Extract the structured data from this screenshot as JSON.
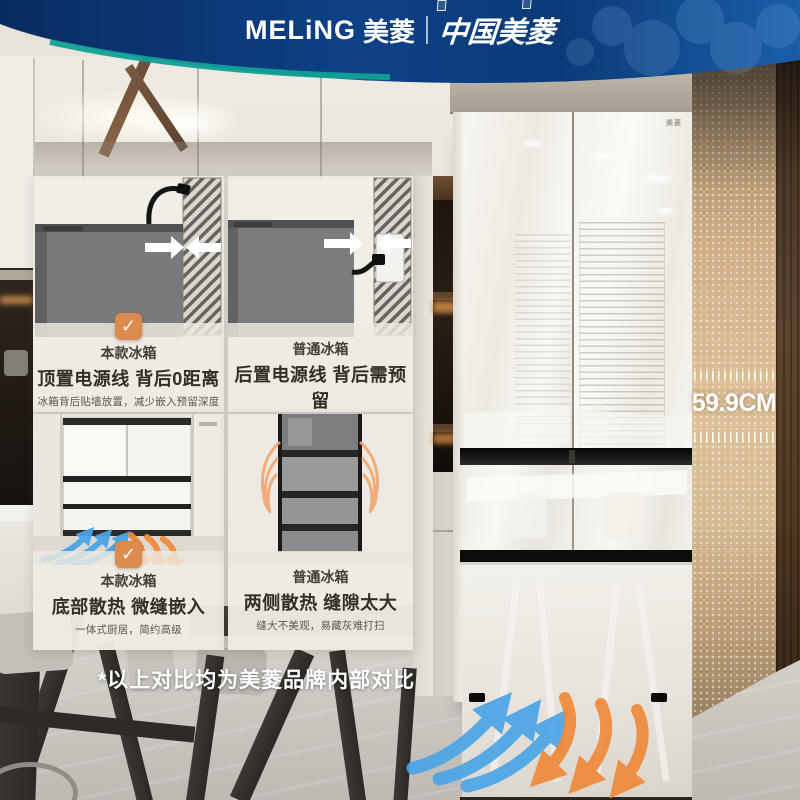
{
  "header": {
    "brand_en": "MELiNG",
    "brand_cn": "美菱",
    "divider": "|",
    "sub_brand": "中国美菱"
  },
  "panels": [
    {
      "badge": "✓",
      "label": "本款冰箱",
      "title": "顶置电源线 背后0距离",
      "desc": "冰箱背后贴墙放置，减少嵌入预留深度"
    },
    {
      "label": "普通冰箱",
      "title": "后置电源线 背后需预留",
      "desc": "需预留电源线材及插座厚度"
    },
    {
      "badge": "✓",
      "label": "本款冰箱",
      "title": "底部散热 微缝嵌入",
      "desc": "一体式厨居，简约高级"
    },
    {
      "label": "普通冰箱",
      "title": "两侧散热 缝隙太大",
      "desc": "缝大不美观，易藏灰难打扫"
    }
  ],
  "fridge": {
    "logo": "美菱"
  },
  "measurement": {
    "value": "59.9CM"
  },
  "disclaimer": "*以上对比均为美菱品牌内部对比",
  "colors": {
    "banner_blue": "#0c3c7c",
    "teal_accent": "#12a096",
    "check_orange": "#dd8a4f",
    "cool_air_blue": "#4aa5e6",
    "warm_air_orange": "#ef8a3b",
    "side_panel_tan": "#cfae85"
  }
}
